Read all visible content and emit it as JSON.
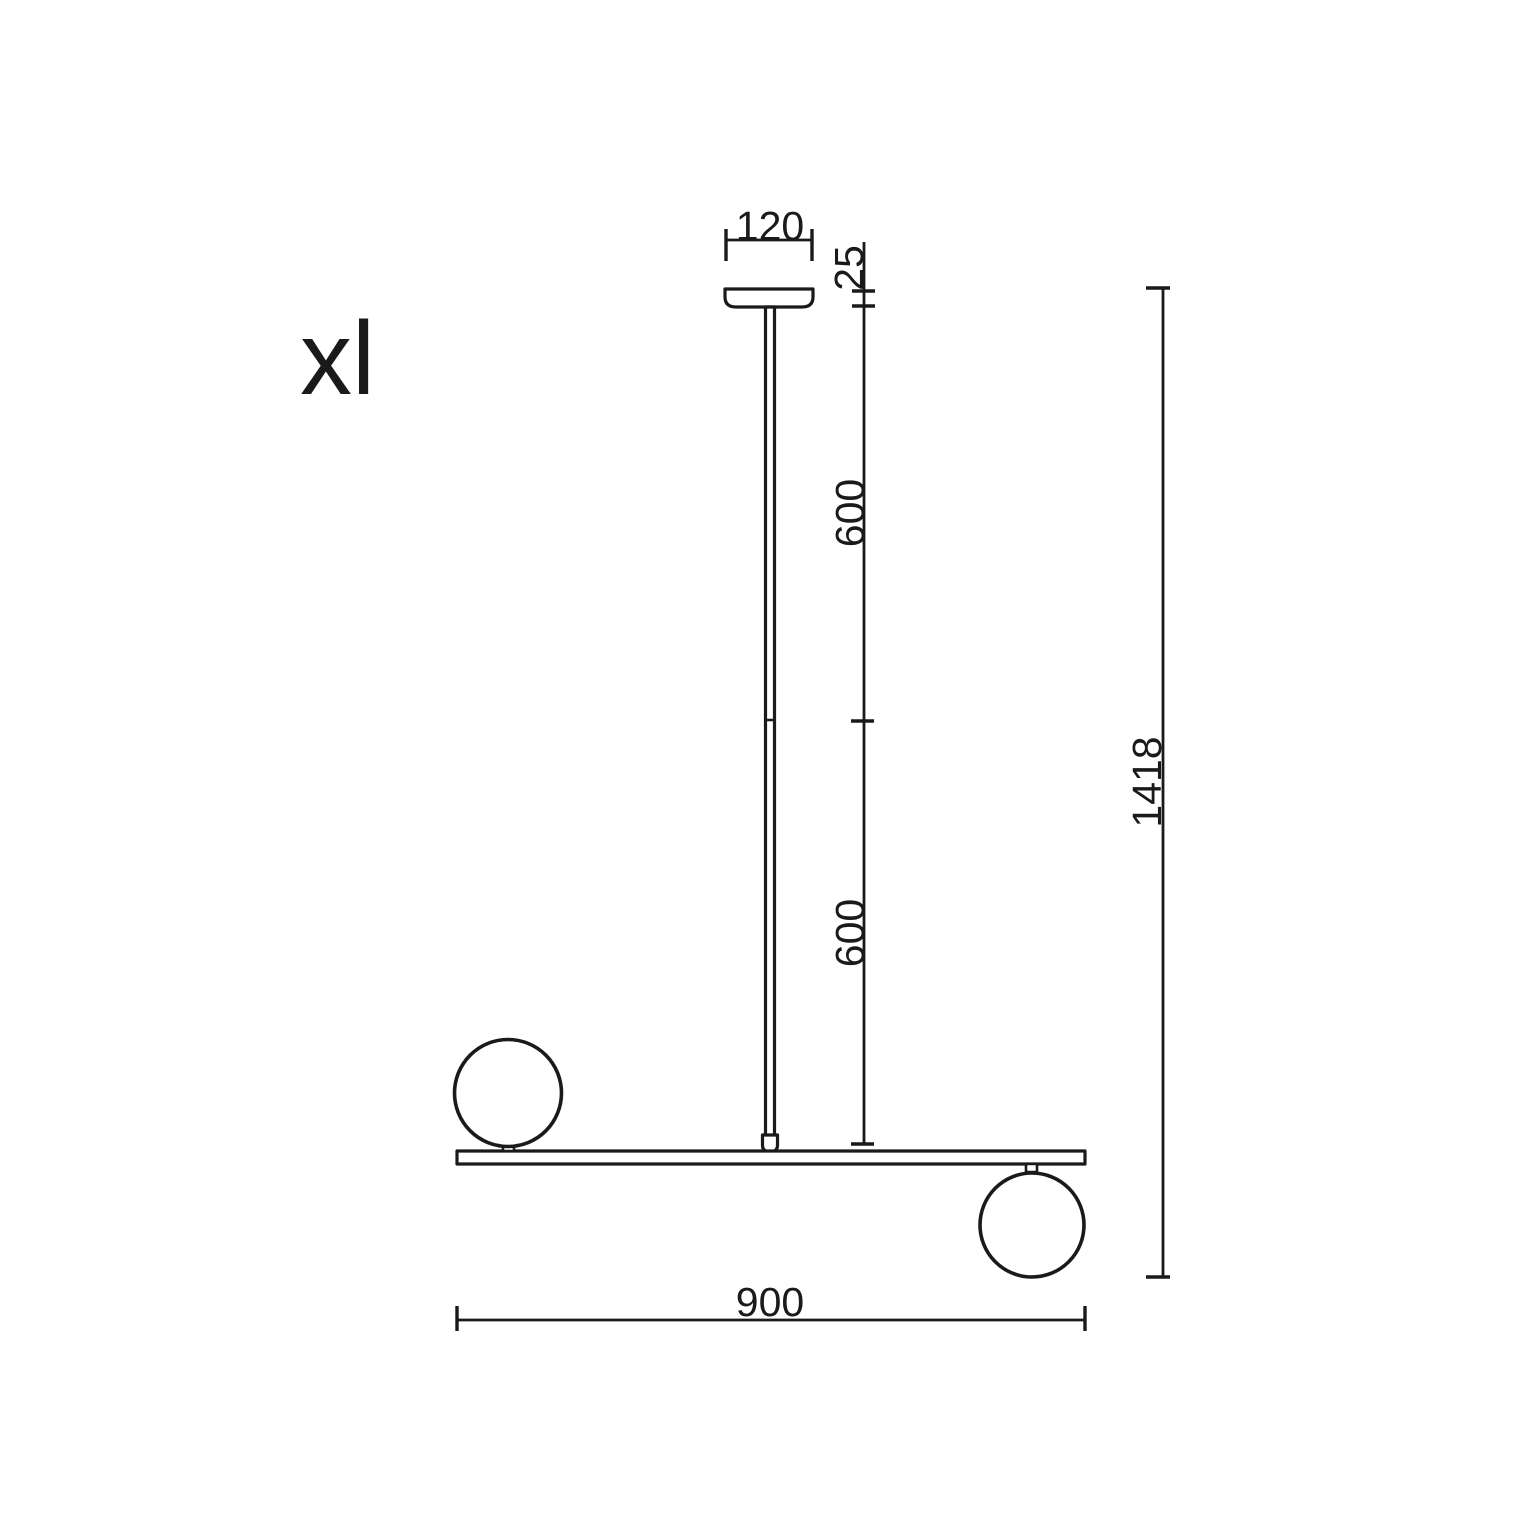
{
  "label": {
    "variant": "xl"
  },
  "dimensions": {
    "canopy_width_mm": "120",
    "canopy_height_mm": "25",
    "stem_upper_mm": "600",
    "stem_lower_mm": "600",
    "total_height_mm": "1418",
    "bar_length_mm": "900"
  },
  "colors": {
    "line": "#1a1a1a",
    "background": "#ffffff"
  }
}
